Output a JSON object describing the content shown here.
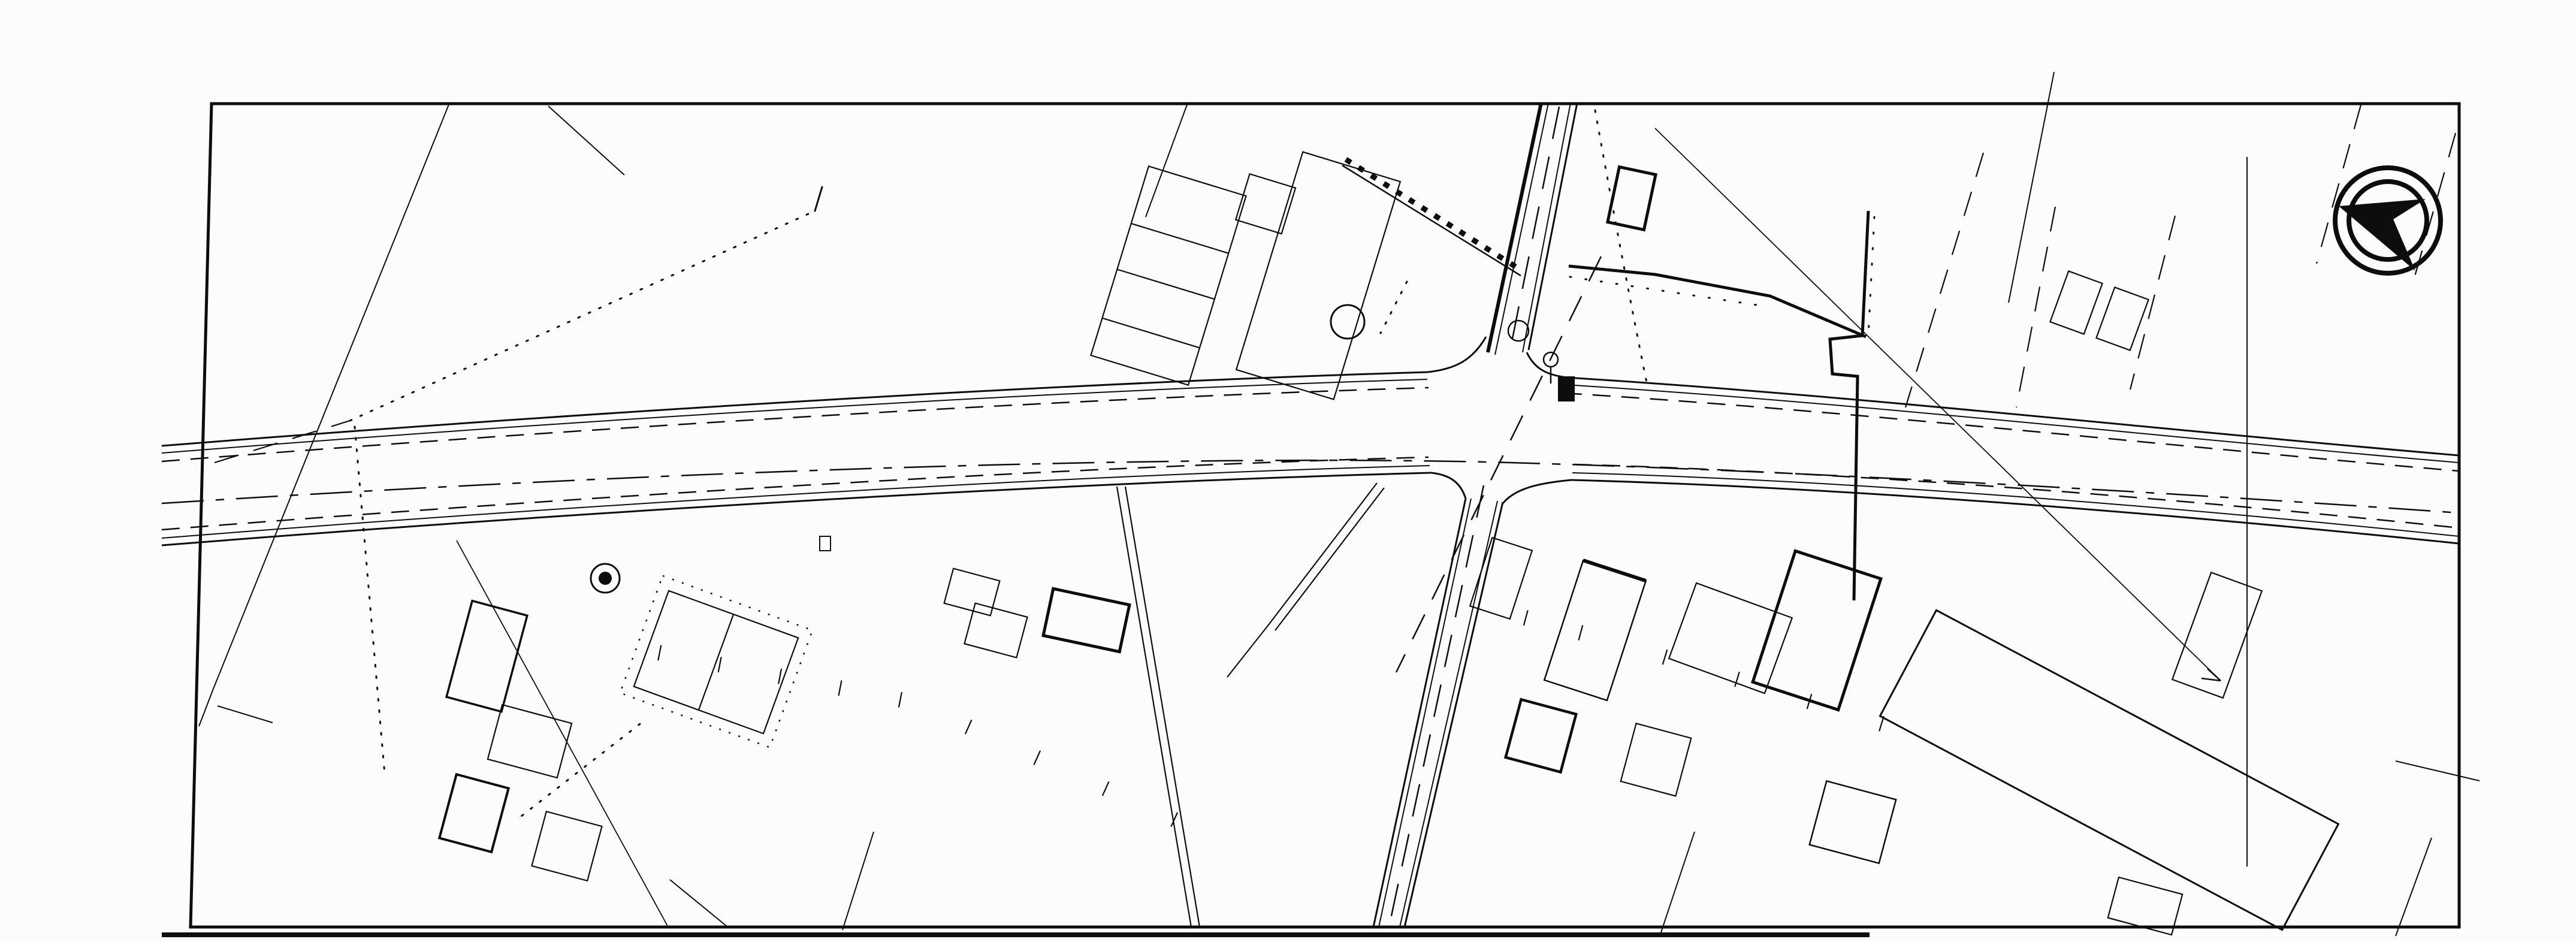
{
  "header": {
    "scale": "1:1,000",
    "title": "岐阜県道路台帳",
    "route_label": "路線番号",
    "route_open": "（",
    "route_number": "23 − 19",
    "route_close": "）"
  },
  "margins": {
    "left_sheet": "— 18 （",
    "right_sheet": "（ 20 —"
  },
  "map": {
    "paddy_mark": "||",
    "labels": {
      "g657t": "−65.7",
      "g431tl": "−43.1",
      "g657l": "−65.7",
      "g432l": "−43.2",
      "g432b": "−43.2",
      "g658t": "−65.8",
      "g658b": "−65.8",
      "g659t": "−65.9",
      "g659b": "−65.9",
      "g431r": "−43.1",
      "g660r": "−66.0",
      "e82": "·8.2",
      "e94a": "·9.4",
      "e92": "·9.2",
      "e91t": "·9.1",
      "e83a": "·8.3",
      "e83b": "·8.3",
      "e900": "·9.00",
      "e916": "·9.1",
      "e912": "9.12·",
      "e917": "·9.1",
      "e91b1": "·9.1",
      "e91b2": "·9.1",
      "e91b3": "·9.1",
      "e94b": "·9.4",
      "e95": "9.5",
      "sta6": "6",
      "sta7": "7",
      "asL": "As",
      "asR": "As",
      "d115a": "11.5",
      "d115b": "11.5",
      "d115c": "11.5",
      "d118a": "11.8",
      "d118b": "11.8",
      "tb": "T.B",
      "factory": "日進木材工業",
      "nMark": "N",
      "sym1": "駐",
      "sym2": "F"
    }
  }
}
